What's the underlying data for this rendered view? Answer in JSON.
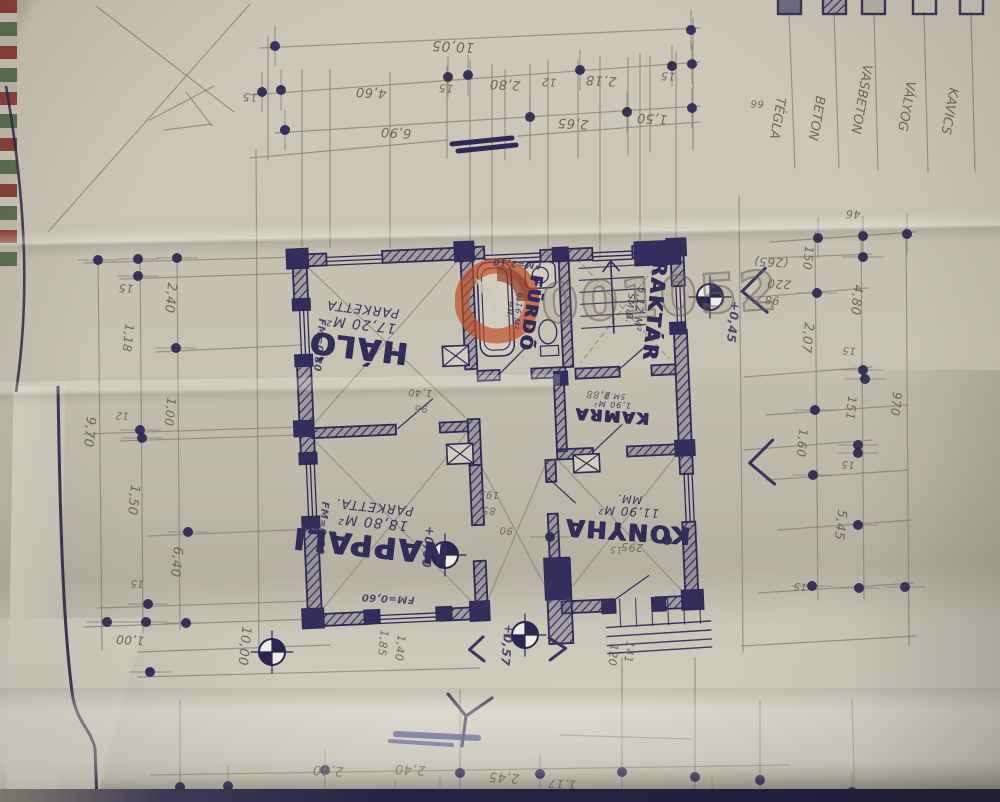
{
  "watermark": {
    "text": "001052",
    "logo": "flame-icon",
    "logo_color": "#bf4e24"
  },
  "legend": {
    "items": [
      {
        "label": "TÉGLA",
        "swatch": "solid"
      },
      {
        "label": "BETON",
        "swatch": "hatch"
      },
      {
        "label": "VASBETON",
        "swatch": "shade"
      },
      {
        "label": "VÁLYOG",
        "swatch": "outline"
      },
      {
        "label": "KAVICS",
        "swatch": "outline"
      }
    ]
  },
  "rooms": [
    {
      "name": "HÁLÓ",
      "area": "17,20 M²",
      "floor": "PARKETTA",
      "x": 360,
      "y": 332,
      "r": 187,
      "s": 30
    },
    {
      "name": "NAPPALI",
      "area": "18,80 M²",
      "floor": "PARKETTA.",
      "x": 372,
      "y": 530,
      "r": 186,
      "s": 30
    },
    {
      "name": "FÜRDŐ",
      "area": "6,16 M²",
      "floor": "MM.",
      "x": 522,
      "y": 312,
      "r": 99,
      "s": 17
    },
    {
      "name": "RAKTÁR",
      "area": "5,12 M²",
      "floor": "SM.B.",
      "x": 644,
      "y": 310,
      "r": 96,
      "s": 20
    },
    {
      "name": "KAMRA",
      "area": "1,90 M²",
      "floor": "SM.B.",
      "x": 612,
      "y": 408,
      "r": 184,
      "s": 16
    },
    {
      "name": "KONYHA",
      "area": "11,90 M²",
      "floor": "MM.",
      "x": 628,
      "y": 518,
      "r": 184,
      "s": 24
    }
  ],
  "annotations": [
    {
      "t": "10,05",
      "x": 453,
      "y": 46,
      "r": 183,
      "s": 14,
      "k": "p"
    },
    {
      "t": "15",
      "x": 250,
      "y": 97,
      "r": 183,
      "s": 11,
      "k": "p"
    },
    {
      "t": "4,60",
      "x": 371,
      "y": 92,
      "r": 183,
      "s": 13,
      "k": "p"
    },
    {
      "t": "15",
      "x": 446,
      "y": 88,
      "r": 183,
      "s": 11,
      "k": "p"
    },
    {
      "t": "2,80",
      "x": 505,
      "y": 84,
      "r": 183,
      "s": 13,
      "k": "p"
    },
    {
      "t": "12",
      "x": 549,
      "y": 82,
      "r": 183,
      "s": 11,
      "k": "p"
    },
    {
      "t": "2,18",
      "x": 601,
      "y": 80,
      "r": 183,
      "s": 13,
      "k": "p"
    },
    {
      "t": "15",
      "x": 668,
      "y": 76,
      "r": 183,
      "s": 11,
      "k": "p"
    },
    {
      "t": "6,90",
      "x": 396,
      "y": 132,
      "r": 183,
      "s": 13,
      "k": "p"
    },
    {
      "t": "2,65",
      "x": 573,
      "y": 123,
      "r": 183,
      "s": 13,
      "k": "p"
    },
    {
      "t": "1,50",
      "x": 652,
      "y": 118,
      "r": 183,
      "s": 13,
      "k": "p"
    },
    {
      "t": "66",
      "x": 757,
      "y": 103,
      "r": 183,
      "s": 10,
      "k": "p"
    },
    {
      "t": "46",
      "x": 853,
      "y": 214,
      "r": 183,
      "s": 11,
      "k": "p"
    },
    {
      "t": "15",
      "x": 126,
      "y": 288,
      "r": 183,
      "s": 11,
      "k": "p"
    },
    {
      "t": "1,18",
      "x": 128,
      "y": 338,
      "r": 96,
      "s": 12,
      "k": "p"
    },
    {
      "t": "2,40",
      "x": 170,
      "y": 298,
      "r": 96,
      "s": 13,
      "k": "p"
    },
    {
      "t": "9,70",
      "x": 89,
      "y": 432,
      "r": 96,
      "s": 13,
      "k": "p"
    },
    {
      "t": "12",
      "x": 122,
      "y": 415,
      "r": 183,
      "s": 10,
      "k": "p"
    },
    {
      "t": "1,00",
      "x": 170,
      "y": 412,
      "r": 96,
      "s": 12,
      "k": "p"
    },
    {
      "t": "1,50",
      "x": 133,
      "y": 500,
      "r": 96,
      "s": 13,
      "k": "p"
    },
    {
      "t": "6,40",
      "x": 176,
      "y": 562,
      "r": 96,
      "s": 13,
      "k": "p"
    },
    {
      "t": "15",
      "x": 137,
      "y": 583,
      "r": 183,
      "s": 10,
      "k": "p"
    },
    {
      "t": "1,00",
      "x": 130,
      "y": 640,
      "r": 183,
      "s": 12,
      "k": "p"
    },
    {
      "t": "10,00",
      "x": 244,
      "y": 646,
      "r": 96,
      "s": 13,
      "k": "p"
    },
    {
      "t": "(265)",
      "x": 771,
      "y": 262,
      "r": 183,
      "s": 12,
      "k": "p"
    },
    {
      "t": "220",
      "x": 779,
      "y": 284,
      "r": 183,
      "s": 12,
      "k": "p"
    },
    {
      "t": "98",
      "x": 772,
      "y": 300,
      "r": 183,
      "s": 11,
      "k": "p"
    },
    {
      "t": "150",
      "x": 808,
      "y": 258,
      "r": 96,
      "s": 12,
      "k": "p"
    },
    {
      "t": "4,80",
      "x": 856,
      "y": 300,
      "r": 96,
      "s": 13,
      "k": "p"
    },
    {
      "t": "15",
      "x": 849,
      "y": 350,
      "r": 183,
      "s": 10,
      "k": "p"
    },
    {
      "t": "2,07",
      "x": 807,
      "y": 338,
      "r": 96,
      "s": 13,
      "k": "p"
    },
    {
      "t": "151",
      "x": 851,
      "y": 408,
      "r": 96,
      "s": 12,
      "k": "p"
    },
    {
      "t": "970",
      "x": 896,
      "y": 404,
      "r": 96,
      "s": 12,
      "k": "p"
    },
    {
      "t": "1,60",
      "x": 802,
      "y": 443,
      "r": 96,
      "s": 12,
      "k": "p"
    },
    {
      "t": "15",
      "x": 848,
      "y": 464,
      "r": 183,
      "s": 10,
      "k": "p"
    },
    {
      "t": "5,45",
      "x": 840,
      "y": 525,
      "r": 96,
      "s": 13,
      "k": "p"
    },
    {
      "t": "15",
      "x": 800,
      "y": 586,
      "r": 183,
      "s": 10,
      "k": "p"
    },
    {
      "t": "1,85",
      "x": 383,
      "y": 643,
      "r": 96,
      "s": 11,
      "k": "p"
    },
    {
      "t": "1,40",
      "x": 400,
      "y": 648,
      "r": 96,
      "s": 11,
      "k": "p"
    },
    {
      "t": "+0,57",
      "x": 507,
      "y": 645,
      "r": 96,
      "s": 12,
      "k": "i"
    },
    {
      "t": "120",
      "x": 613,
      "y": 655,
      "r": 96,
      "s": 11,
      "k": "p"
    },
    {
      "t": "141",
      "x": 629,
      "y": 652,
      "r": 96,
      "s": 11,
      "k": "p"
    },
    {
      "t": "2,40",
      "x": 328,
      "y": 770,
      "r": 183,
      "s": 13,
      "k": "p"
    },
    {
      "t": "2,40",
      "x": 410,
      "y": 769,
      "r": 183,
      "s": 13,
      "k": "p"
    },
    {
      "t": "2,45",
      "x": 504,
      "y": 777,
      "r": 183,
      "s": 13,
      "k": "p"
    },
    {
      "t": "1,17",
      "x": 562,
      "y": 784,
      "r": 183,
      "s": 12,
      "k": "p"
    },
    {
      "t": "+0,60",
      "x": 428,
      "y": 547,
      "r": 96,
      "s": 12,
      "k": "i"
    },
    {
      "t": "+0,45",
      "x": 733,
      "y": 322,
      "r": 96,
      "s": 12,
      "k": "i"
    },
    {
      "t": "FM=0,80",
      "x": 319,
      "y": 345,
      "r": 96,
      "s": 10,
      "k": "i"
    },
    {
      "t": "FM=0,80",
      "x": 322,
      "y": 528,
      "r": 96,
      "s": 10,
      "k": "i"
    },
    {
      "t": "FM=0,60",
      "x": 388,
      "y": 598,
      "r": 183,
      "s": 10,
      "k": "i"
    },
    {
      "t": "FM=2,10",
      "x": 517,
      "y": 263,
      "r": 185,
      "s": 9,
      "k": "i"
    },
    {
      "t": "195",
      "x": 489,
      "y": 494,
      "r": 183,
      "s": 10,
      "k": "p"
    },
    {
      "t": "85",
      "x": 489,
      "y": 510,
      "r": 183,
      "s": 10,
      "k": "p"
    },
    {
      "t": "90",
      "x": 506,
      "y": 530,
      "r": 183,
      "s": 10,
      "k": "p"
    },
    {
      "t": "295",
      "x": 632,
      "y": 547,
      "r": 183,
      "s": 11,
      "k": "p"
    },
    {
      "t": "15",
      "x": 616,
      "y": 549,
      "r": 183,
      "s": 9,
      "k": "p"
    },
    {
      "t": "1,40",
      "x": 420,
      "y": 392,
      "r": 183,
      "s": 10,
      "k": "p"
    },
    {
      "t": "96",
      "x": 421,
      "y": 408,
      "r": 183,
      "s": 10,
      "k": "p"
    },
    {
      "t": "2,88",
      "x": 598,
      "y": 394,
      "r": 183,
      "s": 10,
      "k": "p"
    }
  ]
}
